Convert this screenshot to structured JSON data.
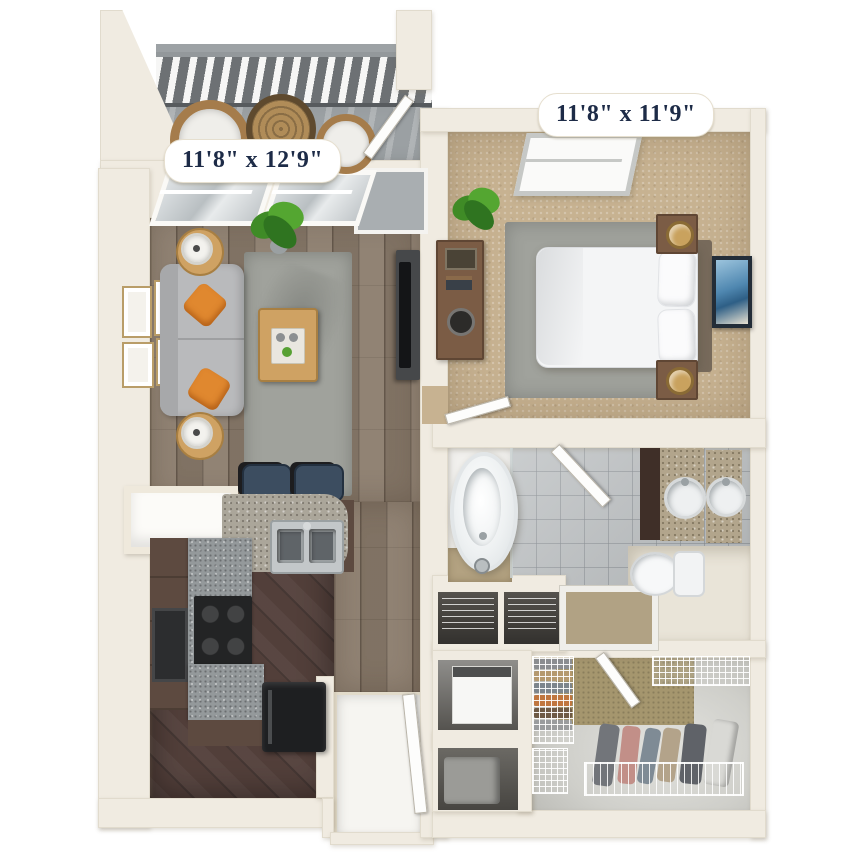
{
  "labels": {
    "living_room": "11'8\" x 12'9\"",
    "bedroom": "11'8\" x 11'9\""
  },
  "rooms": [
    {
      "name": "balcony"
    },
    {
      "name": "living-room",
      "dimensions": "11'8\" x 12'9\""
    },
    {
      "name": "bedroom",
      "dimensions": "11'8\" x 11'9\""
    },
    {
      "name": "kitchen"
    },
    {
      "name": "bathroom"
    },
    {
      "name": "hallway"
    },
    {
      "name": "entry"
    },
    {
      "name": "walk-in-closet"
    },
    {
      "name": "utility-closet"
    },
    {
      "name": "linen-closet"
    }
  ],
  "colors": {
    "wall": "#f0ebe1",
    "wood": "#8a7b6b",
    "kfloor": "#523f3a",
    "carpet": "#c7b291",
    "tile": "#b6babc",
    "balcony": "#9ba0a3",
    "entry": "#f6f5f1",
    "closetFloor": "#d8d8d3",
    "closetWall": "#a5966e",
    "rug": "#a0a29c",
    "sofa": "#b9babc",
    "pillow": "#e0882f",
    "woodFurn": "#cfa263",
    "cabinet": "#5d4a40",
    "counter": "#94999b",
    "granite": "#b2a58c",
    "appliance": "#1e1f21",
    "bed": "#f4f5f6",
    "nightstand": "#7b5c45",
    "labelText": "#1d2b47",
    "labelBg": "#ffffff",
    "railing": "#6d7174",
    "stool": "#3c4d60",
    "art": "#4f87b0"
  }
}
